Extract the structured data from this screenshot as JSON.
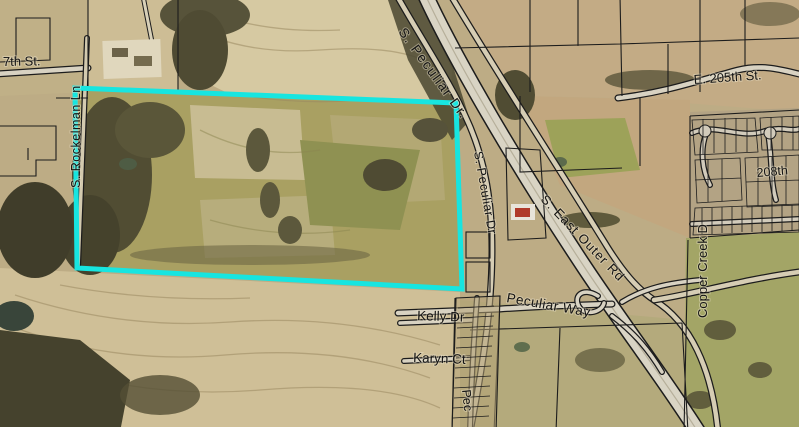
{
  "map": {
    "colors": {
      "highlight": "#17e5e0",
      "parcel_line": "#1c1c1c",
      "road_fill": "#d8d2c2",
      "label_text": "#141414"
    },
    "labels": {
      "street_7th": "7th St.",
      "s_peculiar_dr_top": "S. Peculiar Dr.",
      "e_205th_st": "E. 205th St.",
      "street_208th": "208th",
      "s_rockelman_ln": "S. Rockelman Ln",
      "s_peculiar_dr_mid": "S. Peculiar Dr",
      "s_east_outer_rd": "S. East Outer Rd",
      "copper_creek_dr": "Copper Creek D",
      "peculiar_way": "Peculiar Way",
      "kelly_dr": "Kelly Dr",
      "karyn_ct": "Karyn Ct",
      "peculiar_partial": "Pec"
    }
  }
}
